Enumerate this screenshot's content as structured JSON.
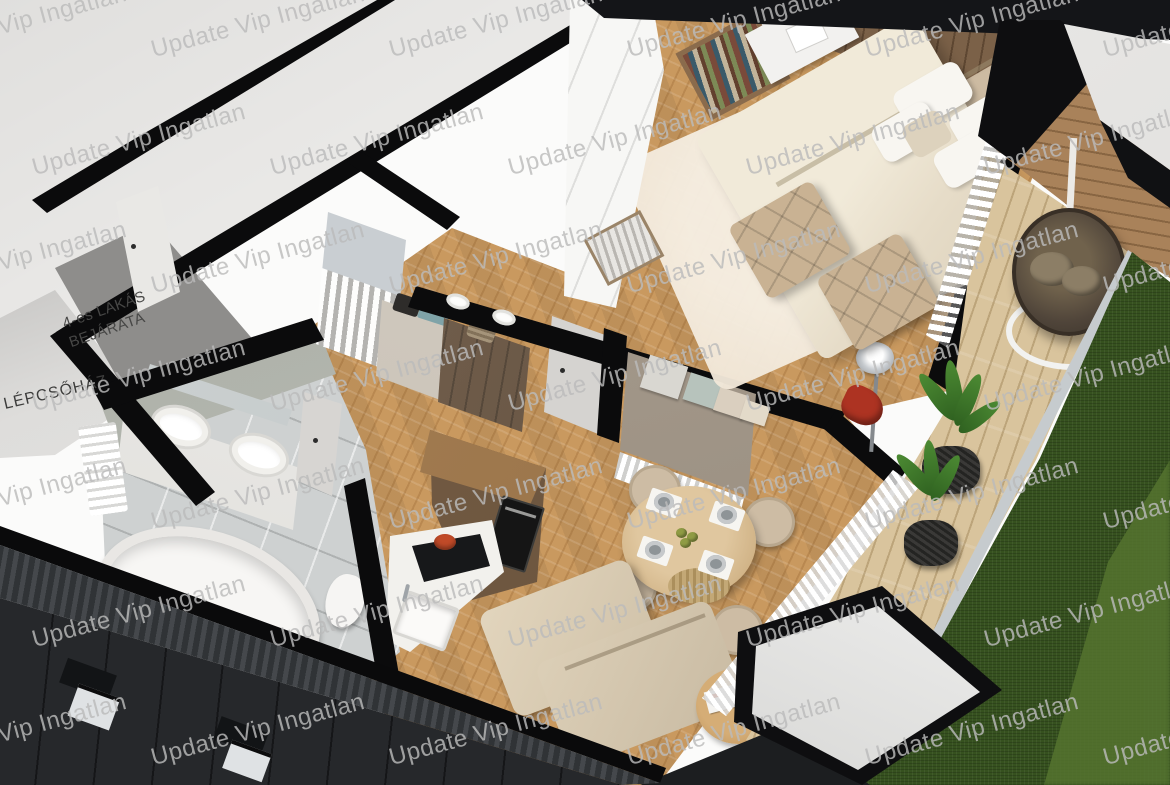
{
  "watermark": {
    "text": "Update Vip Ingatlan",
    "color": "#bbbbbb",
    "opacity": 0.82,
    "angle_deg": -15
  },
  "labels": {
    "apartment_entrance": "4-es LAKÁS\nBEJÁRATA",
    "staircase": "LÉPCSŐHÁZ"
  },
  "palette": {
    "wall_black": "#0b0b0c",
    "oak_floor": "#c9995f",
    "deck_wood": "#d9c49d",
    "bath_tile": "#ced1d1",
    "grass_dark": "#36511f",
    "grass_light": "#557430",
    "facade_dark": "#26282b",
    "facade_coping": "#3a3d42",
    "partition_taupe": "#a2988b",
    "walnut_cabinet": "#6b5540",
    "bed_cream": "#ece4d2",
    "chair_beige": "#cdbca4",
    "accent_red_chair": "#ad3322",
    "accent_pot_red": "#c04a28",
    "landing_gray": "#8e8d8b"
  }
}
